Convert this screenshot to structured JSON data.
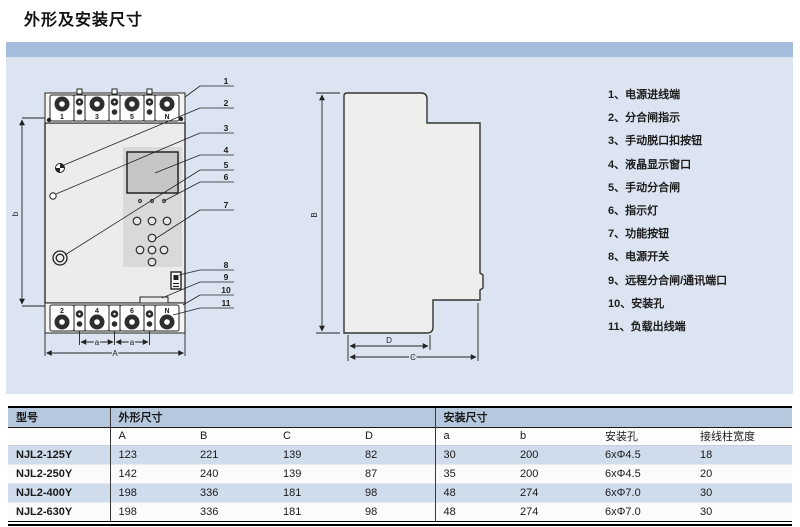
{
  "title": "外形及安装尺寸",
  "legend": {
    "items": [
      "1、电源进线端",
      "2、分合闸指示",
      "3、手动脱口扣按钮",
      "4、液晶显示窗口",
      "5、手动分合闸",
      "6、指示灯",
      "7、功能按钮",
      "8、电源开关",
      "9、远程分合闸/通讯端口",
      "10、安装孔",
      "11、负载出线端"
    ]
  },
  "front_view": {
    "top_terminals": [
      "1",
      "3",
      "5",
      "N"
    ],
    "bottom_terminals": [
      "2",
      "4",
      "6",
      "N"
    ],
    "callouts": [
      "1",
      "2",
      "3",
      "4",
      "5",
      "6",
      "7",
      "8",
      "9",
      "10",
      "11"
    ],
    "dims": {
      "b": "b",
      "a1": "a",
      "a2": "a",
      "A": "A"
    }
  },
  "side_view": {
    "dims": {
      "B": "B",
      "D": "D",
      "C": "C"
    }
  },
  "table": {
    "headers": {
      "model": "型号",
      "outline": "外形尺寸",
      "install": "安装尺寸"
    },
    "sub_headers": [
      "A",
      "B",
      "C",
      "D",
      "a",
      "b",
      "安装孔",
      "接线柱宽度"
    ],
    "rows": [
      [
        "NJL2-125Y",
        "123",
        "221",
        "139",
        "82",
        "30",
        "200",
        "6xΦ4.5",
        "18"
      ],
      [
        "NJL2-250Y",
        "142",
        "240",
        "139",
        "87",
        "35",
        "200",
        "6xΦ4.5",
        "20"
      ],
      [
        "NJL2-400Y",
        "198",
        "336",
        "181",
        "98",
        "48",
        "274",
        "6xΦ7.0",
        "30"
      ],
      [
        "NJL2-630Y",
        "198",
        "336",
        "181",
        "98",
        "48",
        "274",
        "6xΦ7.0",
        "30"
      ]
    ]
  },
  "colors": {
    "top_bar": "#a6bedd",
    "panel_bg": "#dce4f2",
    "table_header_bg": "#b5c8de",
    "row_alt_bg": "#cfdcec",
    "drawing_stroke": "#222222"
  }
}
